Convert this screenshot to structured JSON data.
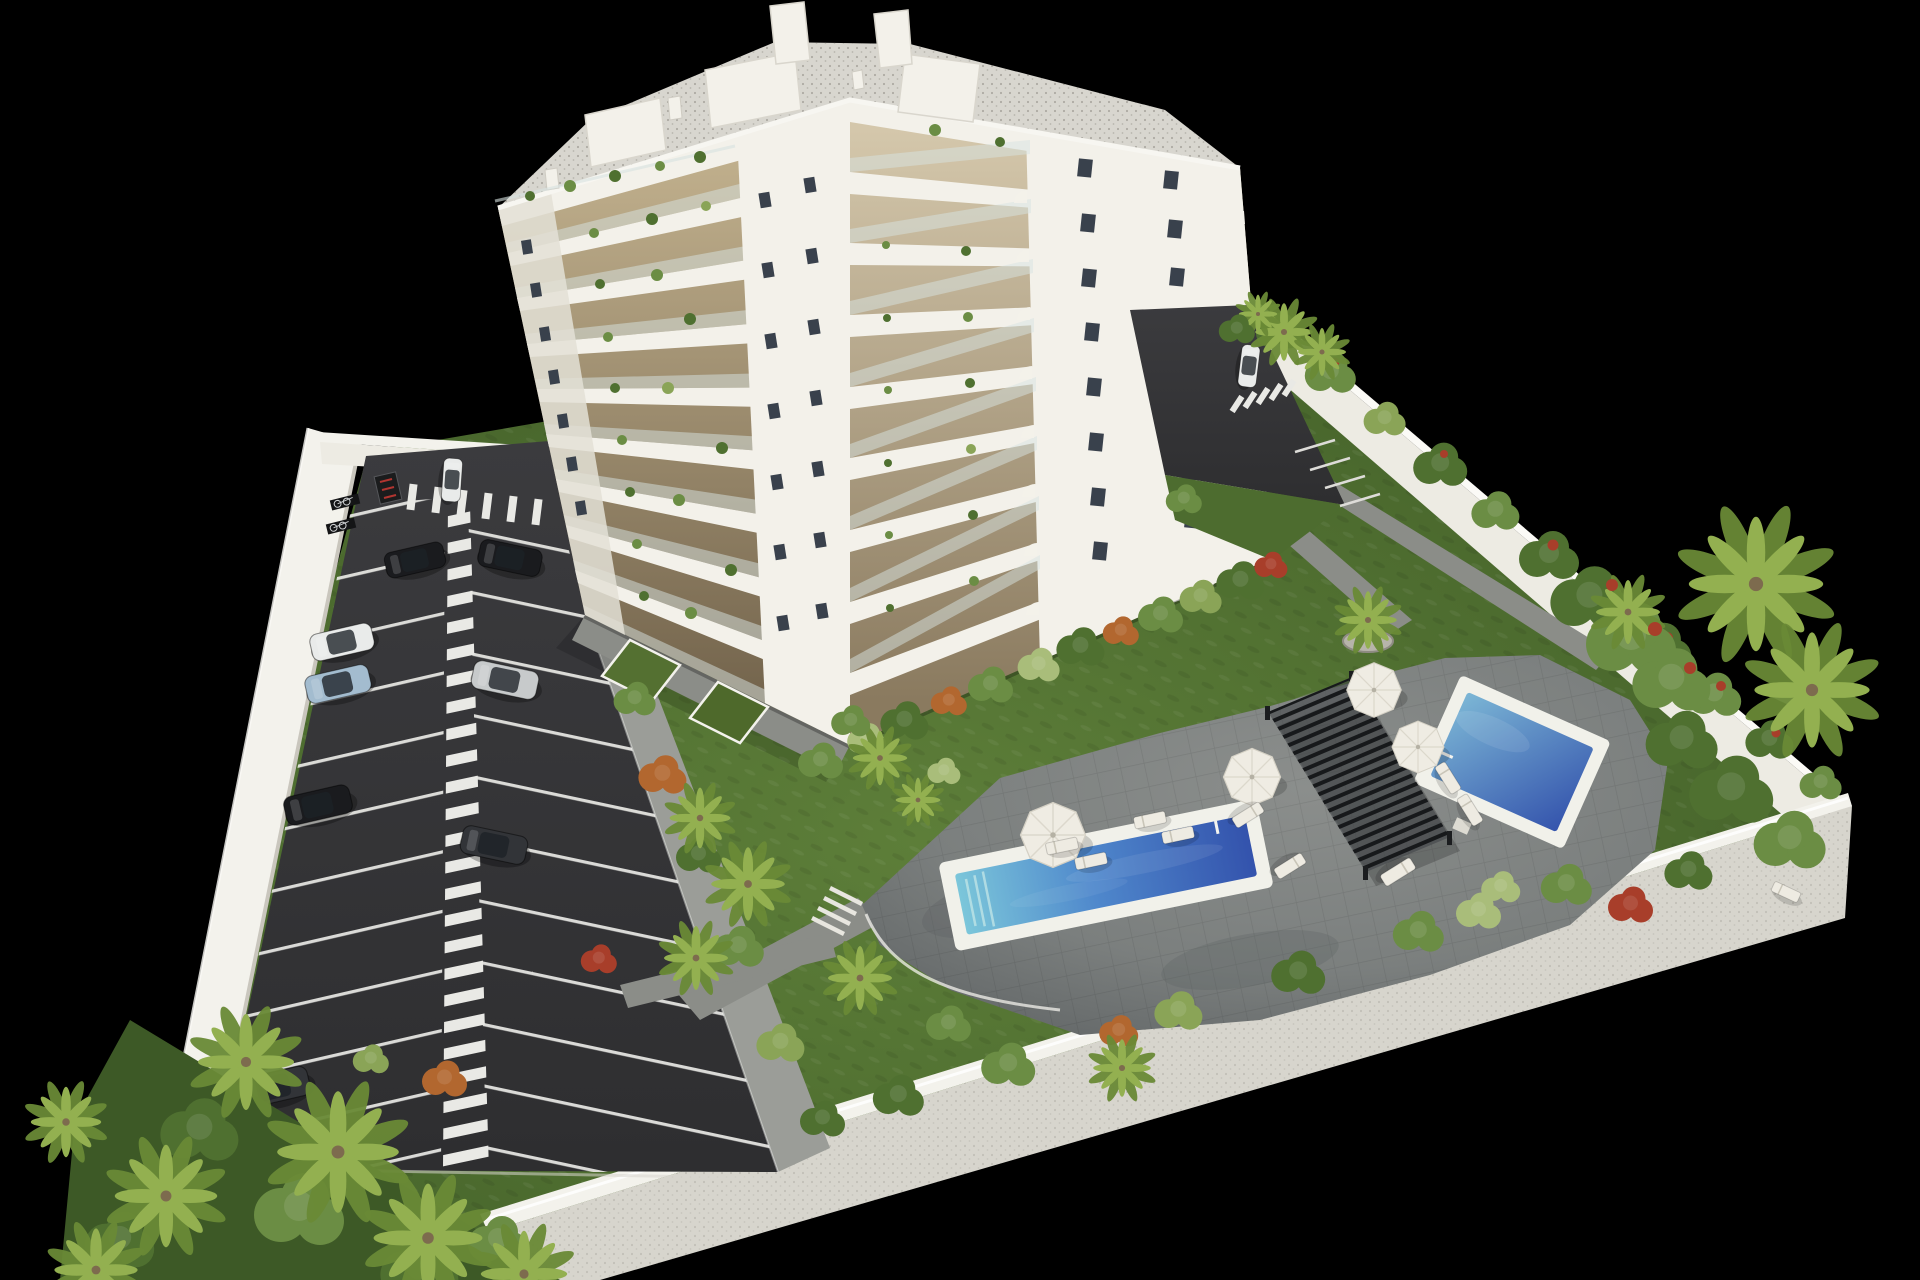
{
  "image": {
    "kind": "3D architectural rendering, aerial view",
    "subject": "White residential apartment block with landscaped grounds, private parking lot, communal gardens and two swimming pools inside a white perimeter wall, rendered on a black background",
    "background": "#000000"
  },
  "scene": {
    "colors": {
      "bg": "#000000",
      "grass": "#4d6c2f",
      "grass-dark": "#3d5926",
      "grass-light": "#5d7e39",
      "asphalt": "#2e2e30",
      "asphalt-light": "#3b3b3e",
      "stripe": "#e9e9e5",
      "walk-gray": "#9b9d98",
      "path-gray": "#8b8d88",
      "deck": "#7b7f7e",
      "deck-dark": "#5f6364",
      "wall-top": "#f3f2ec",
      "wall-face": "#edebe3",
      "wall-outer": "#d7d5cd",
      "building-white": "#f3f1ea",
      "building-shade": "#e3e0d6",
      "balcony-tan": "#c8b793",
      "balcony-deep": "#6d5e47",
      "glass-rail": "#d8e3e1",
      "window-dark": "#39414c",
      "roof-gravel": "#d8d6cf",
      "pool-rim": "#f1f1ea",
      "water-light": "#7cc7da",
      "water-mid": "#4f88cc",
      "water-deep": "#3352ac",
      "pergola": "#26282b",
      "umbrella": "#efece3",
      "lounger": "#eeebe2",
      "car-black": "#1a1b1e",
      "car-white": "#e9ebea",
      "car-blue": "#a3bccf",
      "car-silver": "#c7cacb",
      "car-dark": "#323438",
      "foliage-1": "#4f7030",
      "foliage-2": "#6b8d44",
      "foliage-3": "#8aa457",
      "foliage-4": "#a9bd7a",
      "bush-orange": "#b2672f",
      "bush-red": "#a83e2a",
      "palm-light": "#93b050",
      "palm-dark": "#6a8a36",
      "trunk": "#7d6b4e",
      "planter-gray": "#b7b4aa"
    },
    "counts": {
      "building_floors_visible": 9,
      "penthouse_volumes": 3,
      "roof_stair_towers": 2,
      "parking_cars": 9,
      "driveway_cars": 1,
      "bicycle_racks": 2,
      "motorbike_bays": 2,
      "swimming_pools": 2,
      "parasols": 4,
      "sun_loungers": 11,
      "pergolas": 1,
      "palm_planters": 1,
      "private_garden_terraces": 5
    },
    "areas": [
      "parking-lot",
      "apartment-building",
      "communal-garden",
      "pool-deck",
      "main-pool",
      "upper-pool",
      "pergola-lounge",
      "private-garden-terraces",
      "perimeter-wall",
      "rear-driveway"
    ]
  }
}
